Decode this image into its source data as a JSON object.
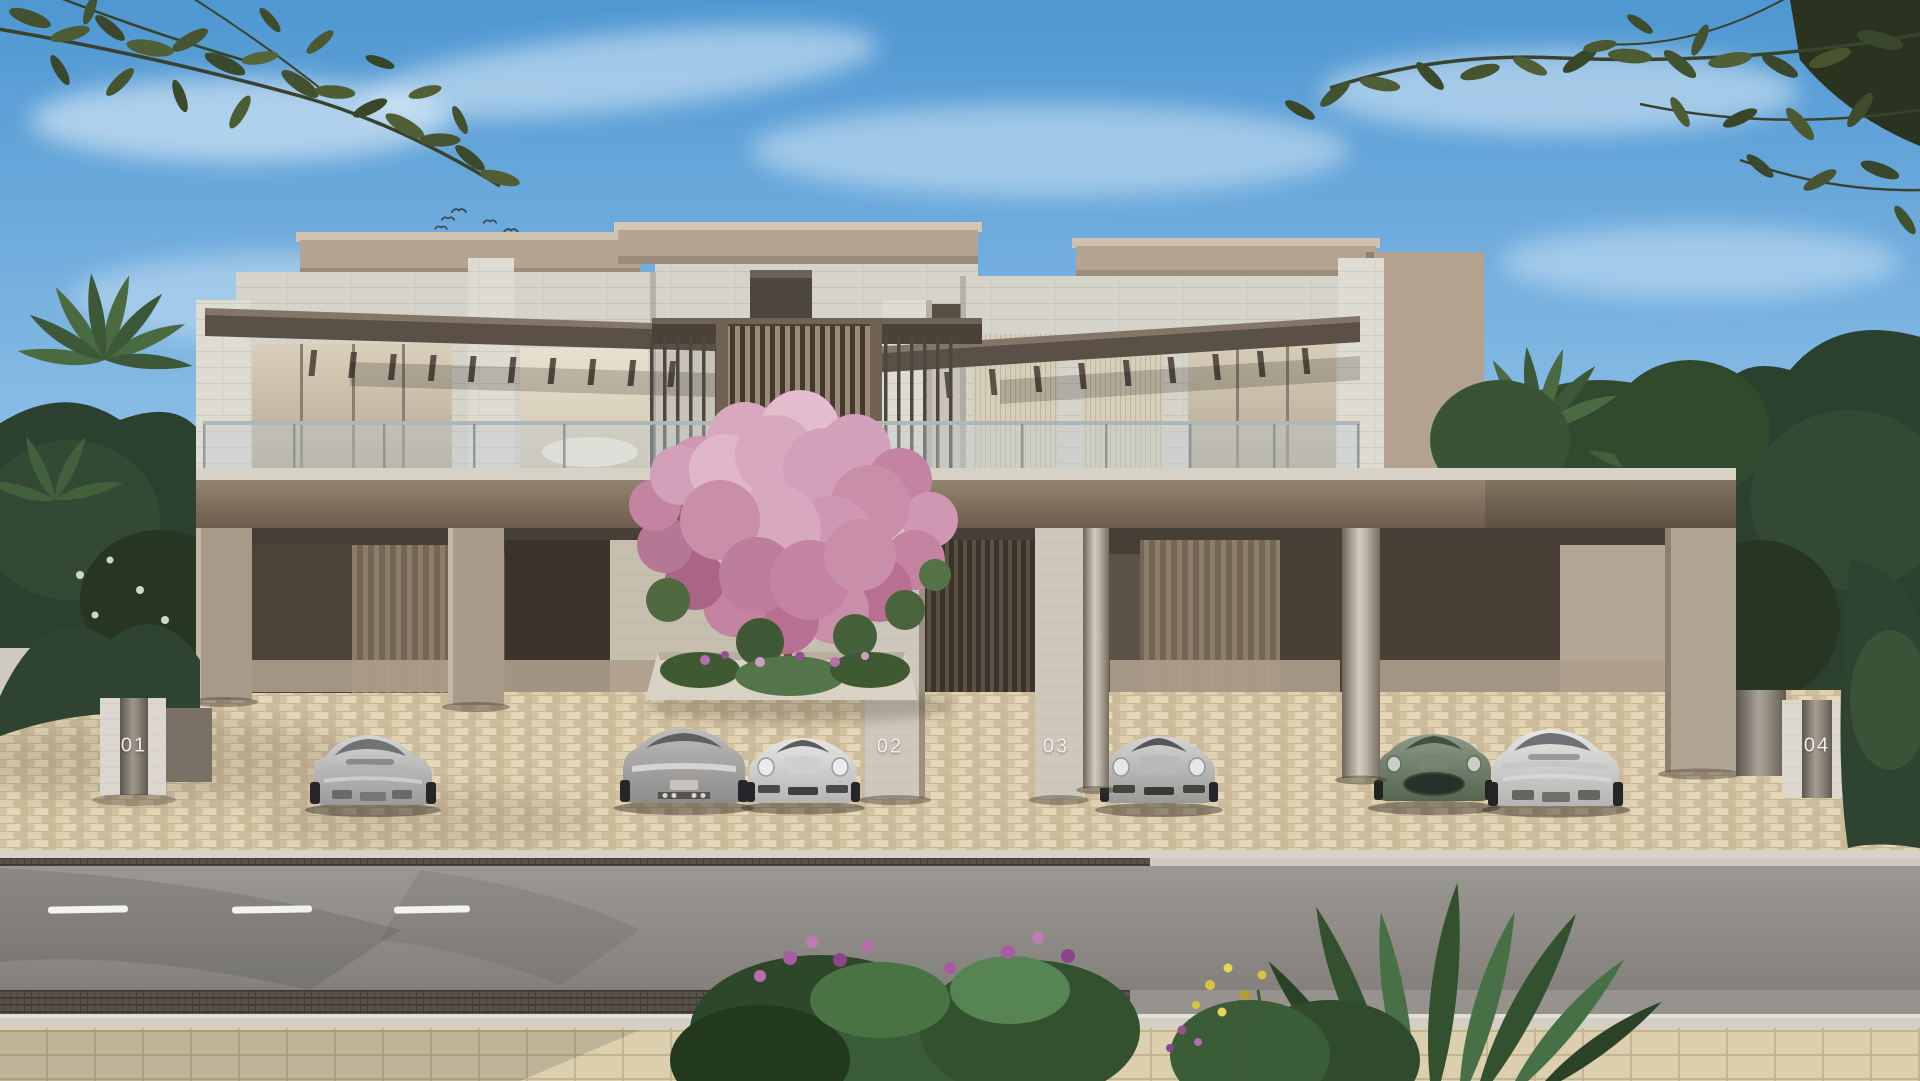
{
  "scene": {
    "description": "Modern two-storey townhouse row exterior rendering with four numbered units, open carports with sports cars, central pink flowering tree, palms, overhanging olive branches and a street foreground",
    "units": [
      {
        "id": "01"
      },
      {
        "id": "02"
      },
      {
        "id": "03"
      },
      {
        "id": "04"
      }
    ],
    "vehicles": [
      "silver-coupe-rear-garage-1",
      "grey-fastback-rear-garage-2",
      "light-silver-coupe-front-garage-2",
      "silver-coupe-front-garage-3",
      "sage-green-coupe-front-garage-4",
      "silver-coupe-rear-garage-4"
    ]
  },
  "palette": {
    "sky_top": "#4f97d2",
    "sky_horizon": "#e9f3fa",
    "stone_wall": "#d6d3ca",
    "roof_tan": "#b5a48f",
    "bronze_fascia": "#77685a",
    "garage_shadow": "#4a4037",
    "paver_beige": "#d5c3a0",
    "asphalt_grey": "#8d8a86",
    "lane_marking_white": "#f2f2ee",
    "blossom_pink": "#cf97b1",
    "foliage_green": "#3d5740",
    "car_silver": "#c6c6c4",
    "car_green": "#697a67",
    "unit_number_text": "#f2efe9"
  }
}
